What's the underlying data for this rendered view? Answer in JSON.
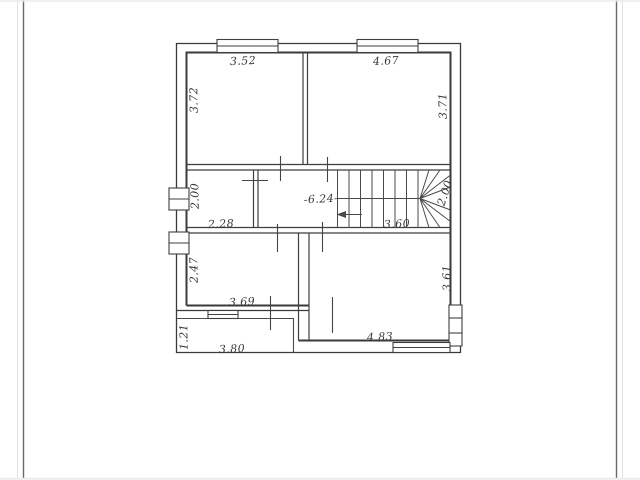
{
  "page": {
    "background": "#ffffff",
    "ink_color": "#3a3a3a",
    "border_color": "#6a6a6a"
  },
  "plan": {
    "type": "floor-plan",
    "dimension_labels": {
      "top_left_room_width": "3.52",
      "top_left_room_depth": "3.72",
      "top_right_room_width": "4.67",
      "top_right_room_depth": "3.71",
      "left_small_room_depth": "2.00",
      "left_small_room_width": "2.28",
      "hallway_length": "-6.24-",
      "stair_run": "3.60",
      "stair_width": "2.00",
      "bottom_left_room_depth": "2.47",
      "bottom_left_room_width": "3.69",
      "bottom_right_room_depth": "3.61",
      "bottom_right_room_width": "4.83",
      "balcony_depth": "1.21",
      "balcony_width": "3.80"
    }
  }
}
